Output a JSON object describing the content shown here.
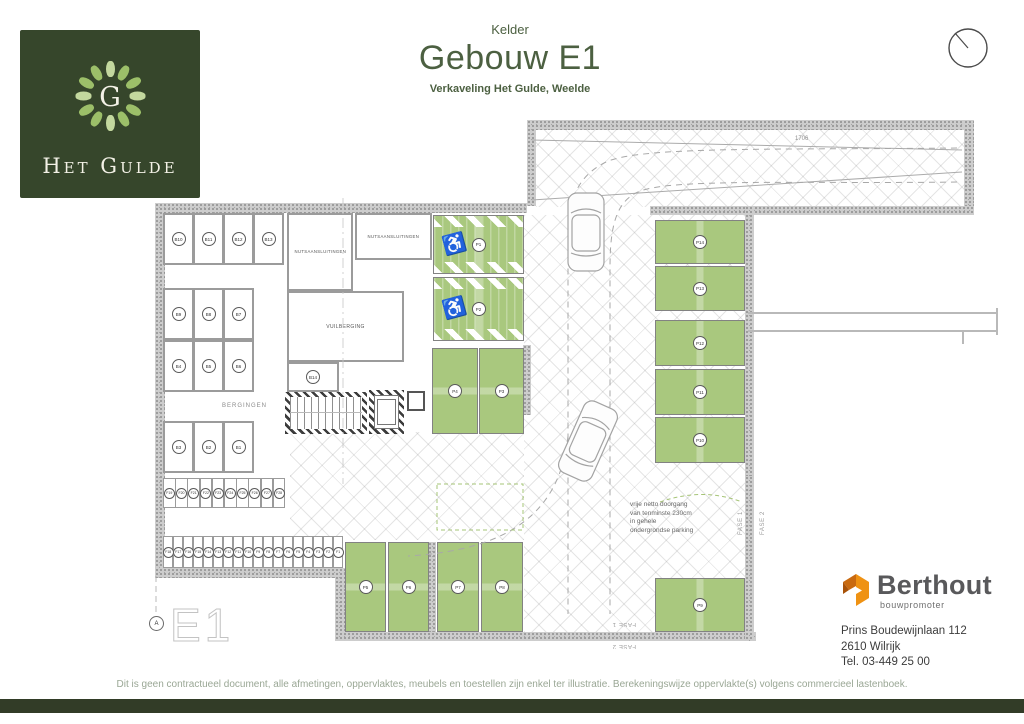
{
  "header": {
    "plan_type": "Kelder",
    "title": "Gebouw E1",
    "subtitle": "Verkaveling Het Gulde, Weelde"
  },
  "logo": {
    "monogram": "G",
    "name": "Het Gulde"
  },
  "plan": {
    "sheet_label": "E1",
    "grid_marker": "A",
    "room_labels": {
      "nuts1": "NUTSAANSLUITINGEN",
      "nuts2": "NUTSAANSLUITINGEN",
      "vuilberging": "VUILBERGING",
      "bergingen": "BERGINGEN"
    },
    "storage_rows": [
      [
        "B10",
        "B11",
        "B12",
        "B13"
      ],
      [
        "B9",
        "B8",
        "B7"
      ],
      [
        "B4",
        "B5",
        "B6"
      ],
      [
        "B3",
        "B2",
        "B1"
      ]
    ],
    "b14_label": "B14",
    "bike_rows": {
      "top": [
        "F19",
        "F20",
        "F21",
        "F22",
        "F23",
        "F24",
        "F25",
        "F26",
        "F27",
        "F28"
      ],
      "bottom": [
        "F18",
        "F17",
        "F16",
        "F15",
        "F14",
        "F13",
        "F12",
        "F11",
        "F10",
        "F9",
        "F8",
        "F7",
        "F6",
        "F5",
        "F4",
        "F3",
        "F2",
        "F1"
      ]
    },
    "parking_spots": [
      "P1",
      "P2",
      "P3",
      "P4",
      "P5",
      "P6",
      "P7",
      "P8",
      "P9",
      "P10",
      "P11",
      "P12",
      "P13",
      "P14"
    ],
    "disabled_spots": [
      "P1",
      "P2"
    ],
    "annotations": {
      "clearance_lines": [
        "vrije netto doorgang",
        "van tenminste 230cm",
        "in gehele",
        "ondergrondse parking"
      ],
      "ramp_dimension": "1706",
      "fase_1": "FASE 1",
      "fase_2": "FASE 2"
    }
  },
  "developer": {
    "brand": "Berthout",
    "tagline": "bouwpromoter",
    "address_lines": [
      "Prins Boudewijnlaan 112",
      "2610 Wilrijk",
      "Tel. 03-449 25 00"
    ]
  },
  "footer": {
    "disclaimer": "Dit is geen contractueel document, alle afmetingen, oppervlaktes, meubels en toestellen zijn enkel ter illustratie. Berekeningswijze oppervlakte(s) volgens commercieel lastenboek."
  },
  "colors": {
    "brand_green_dark": "#36462b",
    "title_green": "#4c6041",
    "parking_green": "#a9c87e",
    "leaf_green": "#9cbf69",
    "berthout_orange": "#e8820d",
    "footer_bar": "#323c27"
  }
}
